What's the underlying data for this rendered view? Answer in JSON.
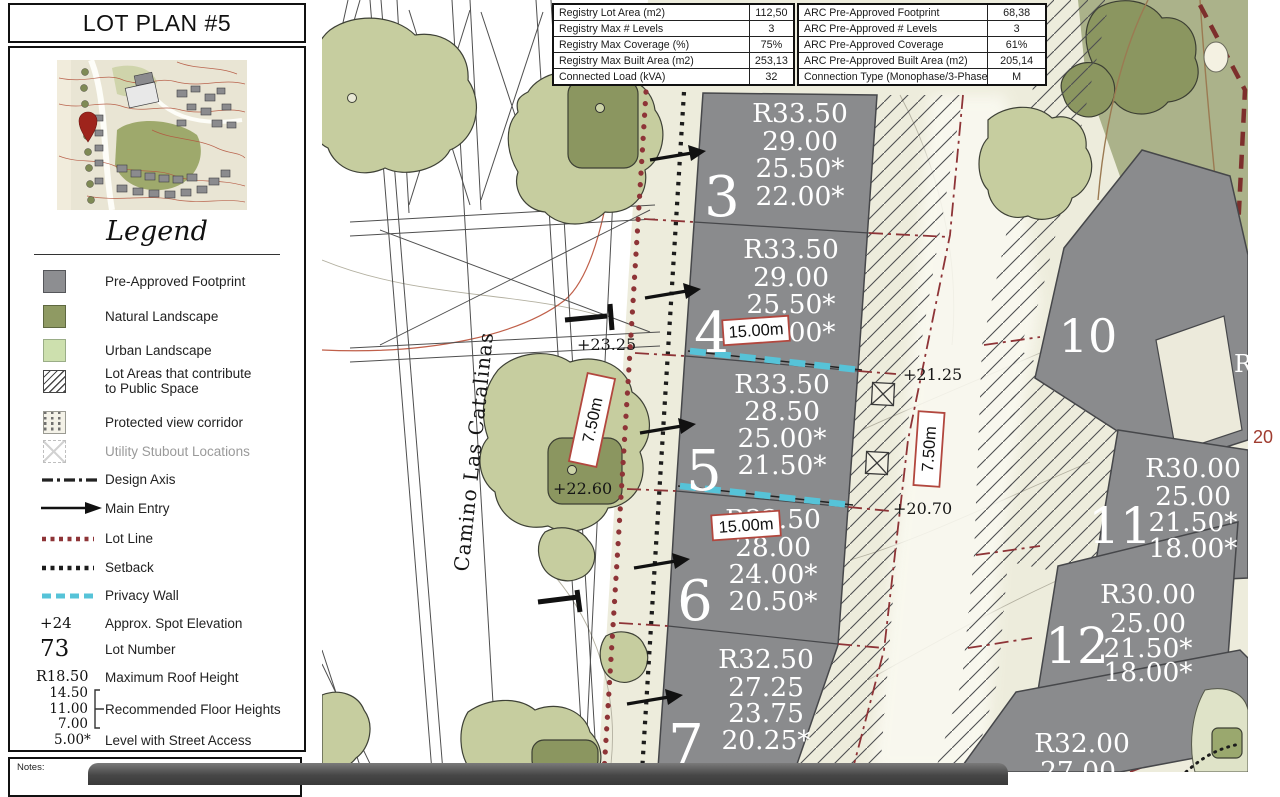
{
  "window": {
    "title_box": "LOT PLAN #5",
    "notes_label": "Notes:"
  },
  "legend": {
    "heading": "Legend",
    "items": [
      {
        "label": "Pre-Approved Footprint"
      },
      {
        "label": "Natural Landscape"
      },
      {
        "label": "Urban Landscape"
      },
      {
        "label": "Lot Areas that contribute to Public Space"
      },
      {
        "label": "Protected view corridor"
      },
      {
        "label": "Utility Stubout Locations"
      },
      {
        "label": "Design Axis"
      },
      {
        "label": "Main Entry"
      },
      {
        "label": "Lot Line"
      },
      {
        "label": "Setback"
      },
      {
        "label": "Privacy Wall"
      },
      {
        "symbol": "+24",
        "label": "Approx. Spot Elevation"
      },
      {
        "symbol": "73",
        "label": "Lot Number"
      },
      {
        "symbol": "R18.50",
        "label": "Maximum Roof Height"
      },
      {
        "symbols": [
          "14.50",
          "11.00",
          "7.00"
        ],
        "label": "Recommended Floor Heights"
      },
      {
        "symbol": "5.00*",
        "label": "Level with Street Access"
      }
    ]
  },
  "table": {
    "left": [
      {
        "label": "Registry Lot Area (m2)",
        "value": "112,50"
      },
      {
        "label": "Registry Max # Levels",
        "value": "3"
      },
      {
        "label": "Registry Max Coverage (%)",
        "value": "75%"
      },
      {
        "label": "Registry Max Built Area (m2)",
        "value": "253,13"
      },
      {
        "label": "Connected Load (kVA)",
        "value": "32"
      }
    ],
    "right": [
      {
        "label": "ARC Pre-Approved Footprint",
        "value": "68,38"
      },
      {
        "label": "ARC Pre-Approved # Levels",
        "value": "3"
      },
      {
        "label": "ARC Pre-Approved Coverage",
        "value": "61%"
      },
      {
        "label": "ARC Pre-Approved Built Area (m2)",
        "value": "205,14"
      },
      {
        "label": "Connection Type (Monophase/3-Phase)",
        "value": "M"
      }
    ]
  },
  "map": {
    "street": "Camino Las Catalinas",
    "lots": [
      {
        "number": "3",
        "h": [
          "R33.50",
          "29.00",
          "25.50*",
          "22.00*"
        ]
      },
      {
        "number": "4",
        "h": [
          "R33.50",
          "29.00",
          "25.50*",
          "22.00*"
        ]
      },
      {
        "number": "5",
        "h": [
          "R33.50",
          "28.50",
          "25.00*",
          "21.50*"
        ]
      },
      {
        "number": "6",
        "h": [
          "R32.50",
          "28.00",
          "24.00*",
          "20.50*"
        ]
      },
      {
        "number": "7",
        "h": [
          "R32.50",
          "27.25",
          "23.75",
          "20.25*"
        ]
      },
      {
        "number": "10",
        "h": []
      },
      {
        "number": "11",
        "h": [
          "R30.00",
          "25.00",
          "21.50*",
          "18.00*"
        ]
      },
      {
        "number": "12",
        "h": [
          "R30.00",
          "25.00",
          "21.50*",
          "18.00*"
        ]
      },
      {
        "number": "",
        "h": [
          "R32.00",
          "27.00"
        ]
      }
    ],
    "edge_lot_partial": "R",
    "margin_label": "20",
    "spots": {
      "a": "+23.25",
      "b": "+22.60",
      "c": "+21.25",
      "d": "+20.70"
    },
    "dims": {
      "wall_a": "15.00m",
      "wall_b": "15.00m",
      "road": "7.50m",
      "corridor": "7.50m"
    }
  },
  "colors": {
    "footprint_gray": "#8a8b8d",
    "natural_landscape": "#8f9a63",
    "urban_landscape": "#cde0ae",
    "lot_line_red": "#8e3437",
    "privacy_wall_cyan": "#56c3d8",
    "dim_box_border": "#b2473e",
    "margin_label_red": "#a03c30"
  }
}
